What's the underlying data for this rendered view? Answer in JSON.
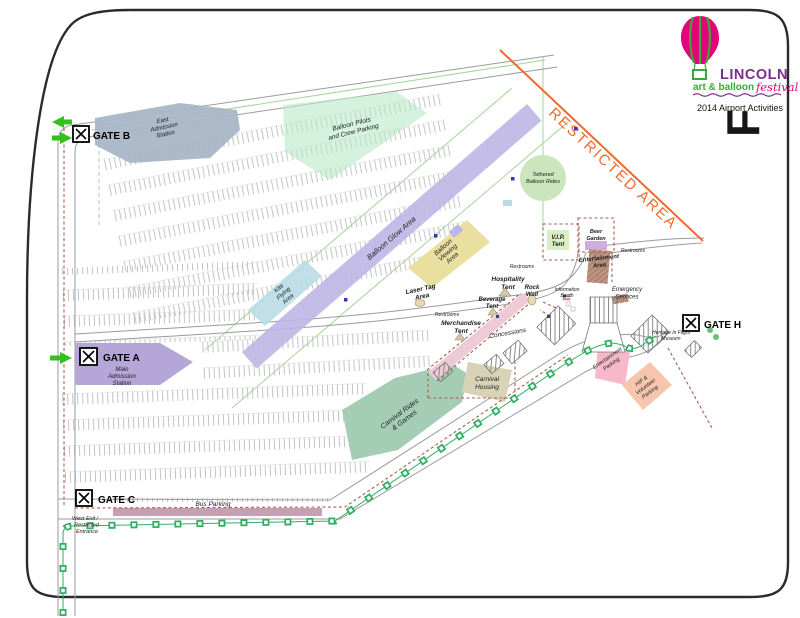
{
  "title_block": {
    "brand": "LINCOLN",
    "brand_sub": "art & balloon",
    "brand_script": "festival",
    "event_line": "2014 Airport Activities",
    "flag_letter": "F"
  },
  "gates": {
    "b": {
      "label": "GATE B",
      "desc": [
        "East",
        "Admission",
        "Station"
      ]
    },
    "a": {
      "label": "GATE A",
      "desc": [
        "Main",
        "Admission",
        "Station"
      ]
    },
    "c": {
      "label": "GATE C"
    },
    "h": {
      "label": "GATE H"
    }
  },
  "labels": {
    "balloon_pilots": [
      "Balloon Pilots",
      "and Crew Parking"
    ],
    "balloon_glow": "Balloon Glow Area",
    "kite": [
      "Kite",
      "Flying",
      "Area"
    ],
    "tethered": [
      "Tethered",
      "Balloon Rides"
    ],
    "viewing": [
      "Balloon",
      "Viewing",
      "Area"
    ],
    "laser": [
      "Laser Tag",
      "Area"
    ],
    "vip": [
      "V.I.P.",
      "Tent"
    ],
    "beer": [
      "Beer",
      "Garden"
    ],
    "ent_area": [
      "Entertainment",
      "Area"
    ],
    "hospitality": [
      "Hospitality",
      "Tent"
    ],
    "rock": [
      "Rock",
      "Wall"
    ],
    "beverage": [
      "Beverage",
      "Tent"
    ],
    "merch": [
      "Merchandise",
      "Tent"
    ],
    "concessions": "Concessions",
    "housing": [
      "Carnival",
      "Housing"
    ],
    "rides": [
      "Carnival Rides",
      "& Games"
    ],
    "ent_parking": [
      "Entertainment",
      "Parking"
    ],
    "hif": [
      "HIF &",
      "Volunteer",
      "Parking"
    ],
    "heritage": [
      "Heritage In Flight",
      "Museum"
    ],
    "info": [
      "Information",
      "Booth"
    ],
    "emergency": [
      "Emergency",
      "Services"
    ],
    "bus": "Bus Parking",
    "west_exit": [
      "West Exit /",
      "Restricted",
      "Entrance"
    ],
    "restrooms": "Restrooms",
    "restricted": "RESTRICTED AREA"
  },
  "colors": {
    "glow": "#bcb6e6",
    "pilots": "#b7e9c6",
    "kite": "#b9dce6",
    "viewing": "#e9e0a0",
    "tethered": "#cbe5bd",
    "vip": "#d9eec3",
    "beer": "#cfaede",
    "ent_area": "#bc9483",
    "rides": "#a5cdb5",
    "housing": "#d8d2b6",
    "ent_parking": "#f7b9ca",
    "hif": "#f8c6ae",
    "gate_a": "#b4a6d6",
    "gate_b": "#a9b6c6",
    "bus": "#c79fb3",
    "concession": "#eec9d6",
    "restricted": "#f2692e",
    "path_green": "#2fae62",
    "dash_brown": "#a8604a",
    "arrow_green": "#35c01e",
    "brand_purple": "#7b2e8e",
    "brand_green": "#3aaa35",
    "brand_pink": "#e5007e"
  }
}
